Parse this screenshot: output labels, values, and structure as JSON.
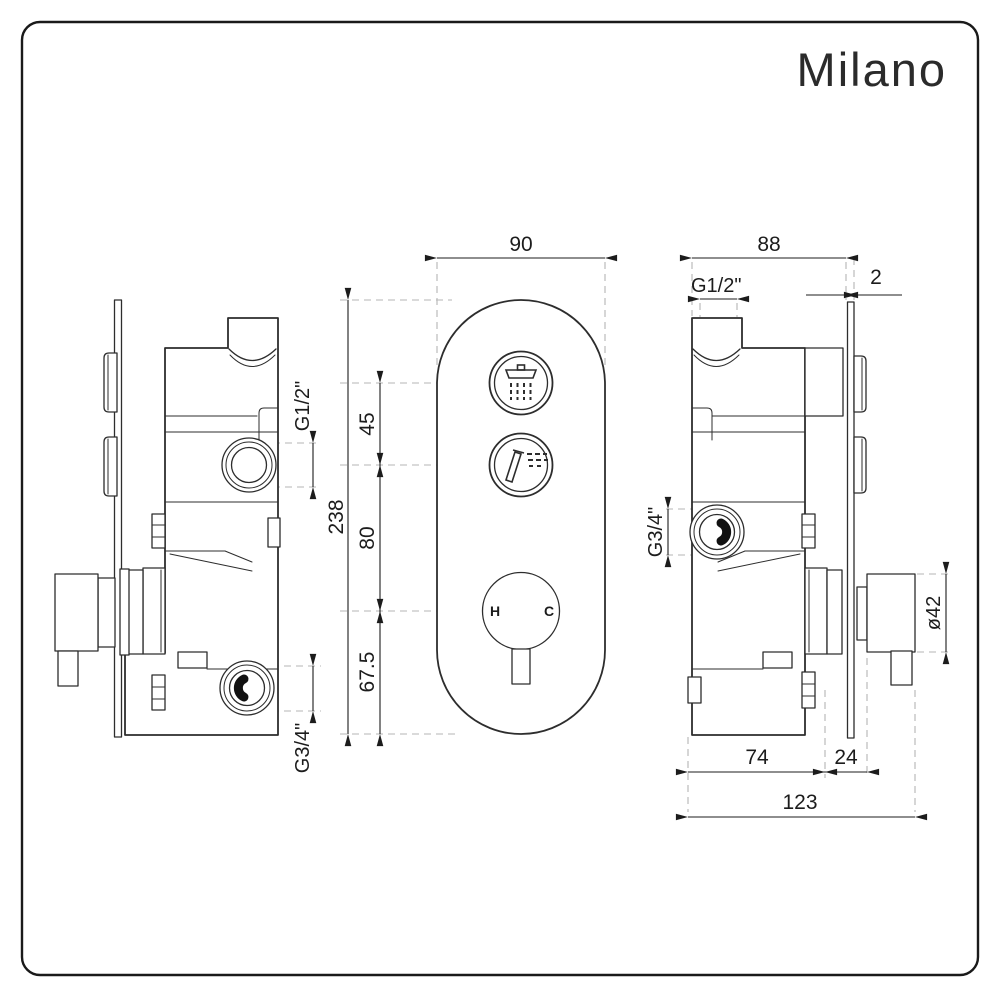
{
  "colors": {
    "background": "#ffffff",
    "line": "#2d2d2d",
    "dimension": "#1c1c1c",
    "dashed_extension": "#b5b5b5"
  },
  "brand": {
    "logo": "Milano"
  },
  "front_view": {
    "dim_width": "90",
    "dim_total_height": "238",
    "dim_button_spacing": "45",
    "dim_button_to_dial": "80",
    "dim_dial_to_bottom": "67.5",
    "dial_hot_label": "H",
    "dial_cold_label": "C",
    "top_button_icon": "overhead-shower-icon",
    "middle_button_icon": "hand-shower-icon"
  },
  "left_side_view": {
    "top_port_label": "G1/2\"",
    "bottom_port_label": "G3/4\""
  },
  "right_side_view": {
    "dim_body_width": "88",
    "dim_plate_thickness": "2",
    "top_port_label": "G1/2\"",
    "side_port_label": "G3/4\"",
    "dim_knob_diameter": "ø42",
    "dim_recess_depth": "74",
    "dim_protrusion": "24",
    "dim_total_depth": "123"
  }
}
